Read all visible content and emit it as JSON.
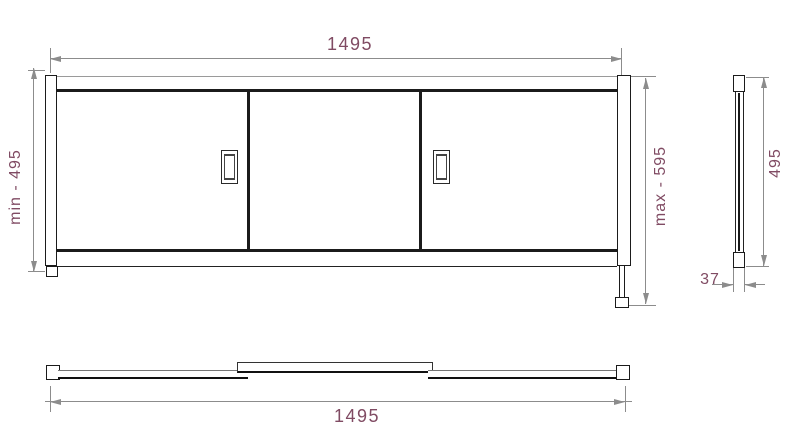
{
  "diagram": {
    "type": "technical-drawing",
    "subject": "Bath panel with three sliding doors, adjustable height feet",
    "labels": {
      "front_width": "1495",
      "front_height_min": "min - 495",
      "front_height_max": "max - 595",
      "side_height": "495",
      "side_depth": "37",
      "plan_width": "1495"
    },
    "front": {
      "doors": 3,
      "handles": 2
    },
    "colors": {
      "dimension_text": "#804b63",
      "dimension_line": "#8c8c8c",
      "object_line": "#1b1b1b",
      "background": "#ffffff"
    }
  }
}
